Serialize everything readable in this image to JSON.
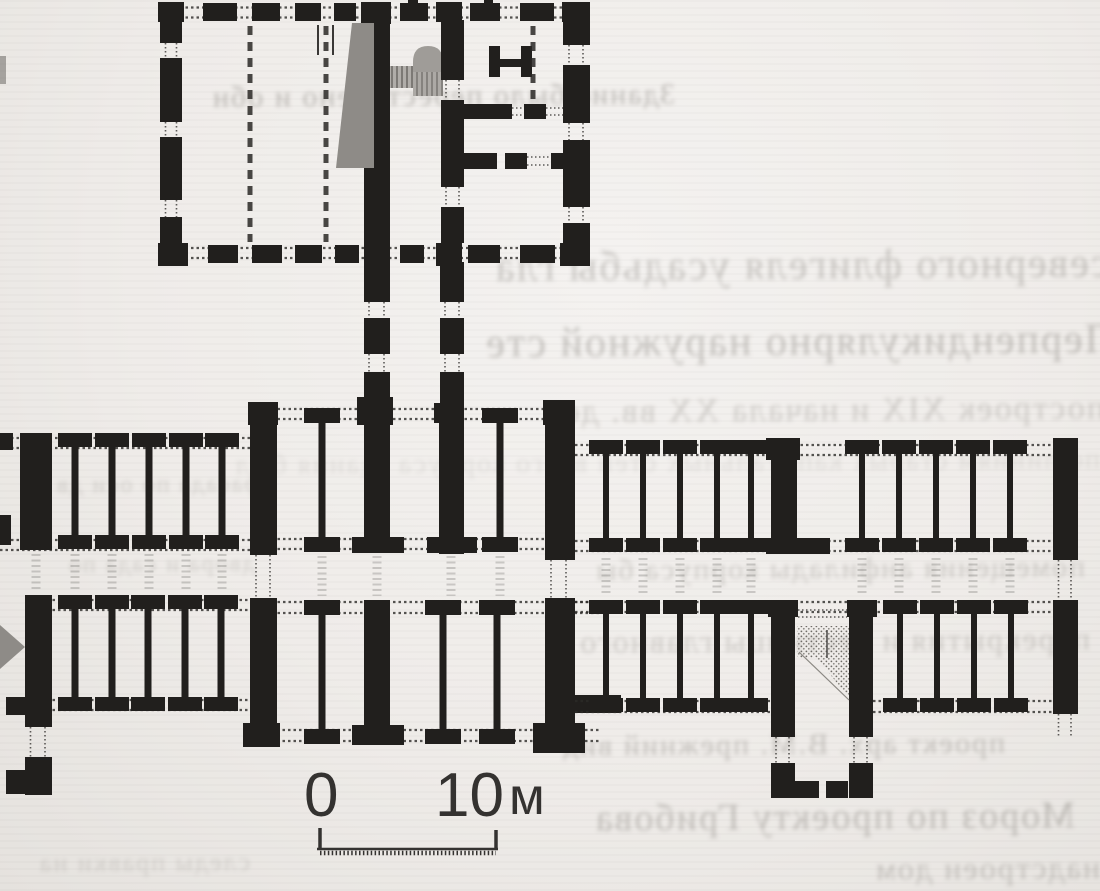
{
  "figure": {
    "kind": "scanned-architectural-floor-plan",
    "ink_color": "#211f1d",
    "paper_color": "#efece9",
    "shade_color": "#8e8b87",
    "elements": [
      "upper-block-with-hall-and-stair",
      "gallery-connector",
      "left-wing",
      "central-block",
      "right-wing-with-stair-bay",
      "scale-bar"
    ]
  },
  "scale_bar": {
    "zero": "0",
    "ten": "10",
    "unit": "м"
  },
  "bleedthrough": {
    "color": "#7e7a74",
    "fragments": [
      {
        "text": "Здание было перестроено и обн"
      },
      {
        "text": "северного флигеля усадьбы гла"
      },
      {
        "text": "Перпендикулярно наружной сте"
      },
      {
        "text": "построек XIX и начала XX вв. до"
      },
      {
        "text": "по линиям старых капитальных стен всего корпуса здания был"
      },
      {
        "text": "фасада по оси дв"
      },
      {
        "text": "помещения анфилады корпуса бы"
      },
      {
        "text": "двора и сада по"
      },
      {
        "text": "перекрытия и лестницы главного д"
      },
      {
        "text": "проект арх. В.М. прежний вид зда"
      },
      {
        "text": "Мороз по проекту Грибова воз"
      },
      {
        "text": "надстроен дом"
      },
      {
        "text": "следы правки на"
      }
    ]
  }
}
